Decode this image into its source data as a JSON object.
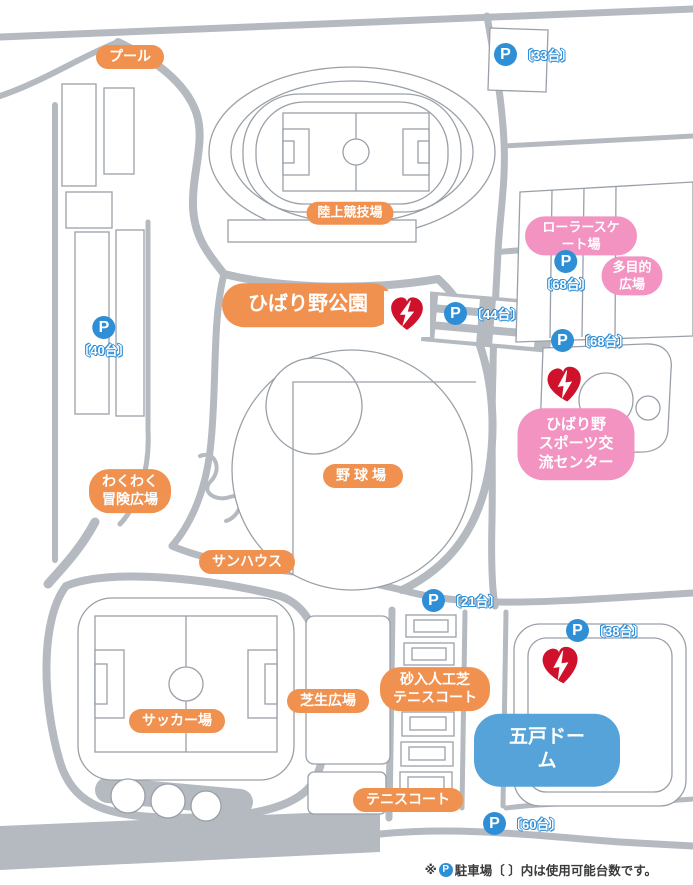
{
  "labels": {
    "pool": "プール",
    "athletics": "陸上競技場",
    "roller": "ローラースケート場",
    "multipurpose": "多目的広場",
    "park": "ひばり野公園",
    "sports_center": "ひばり野\nスポーツ交流センター",
    "adventure": "わくわく\n冒険広場",
    "baseball": "野球場",
    "sunhouse": "サンハウス",
    "soccer": "サッカー場",
    "lawn": "芝生広場",
    "sand_tennis": "砂入人工芝\nテニスコート",
    "dome": "五戸ドーム",
    "tennis": "テニスコート"
  },
  "parking": {
    "letter": "P",
    "p33": "〔33台〕",
    "p40": "〔40台〕",
    "p68a": "〔68台〕",
    "p44": "〔44台〕",
    "p68b": "〔68台〕",
    "p21": "〔21台〕",
    "p38": "〔38台〕",
    "p60": "〔60台〕"
  },
  "aed": {
    "name": "AED"
  },
  "footer": {
    "prefix": "※",
    "p_letter": "P",
    "text": "駐車場〔 〕内は使用可能台数です。"
  },
  "colors": {
    "label_orange": "#F0914F",
    "label_pink": "#F293C1",
    "label_blue": "#55A3D9",
    "parking_blue": "#2F8FD6",
    "aed_red": "#D0112B",
    "road_gray": "#B5B9C0"
  }
}
